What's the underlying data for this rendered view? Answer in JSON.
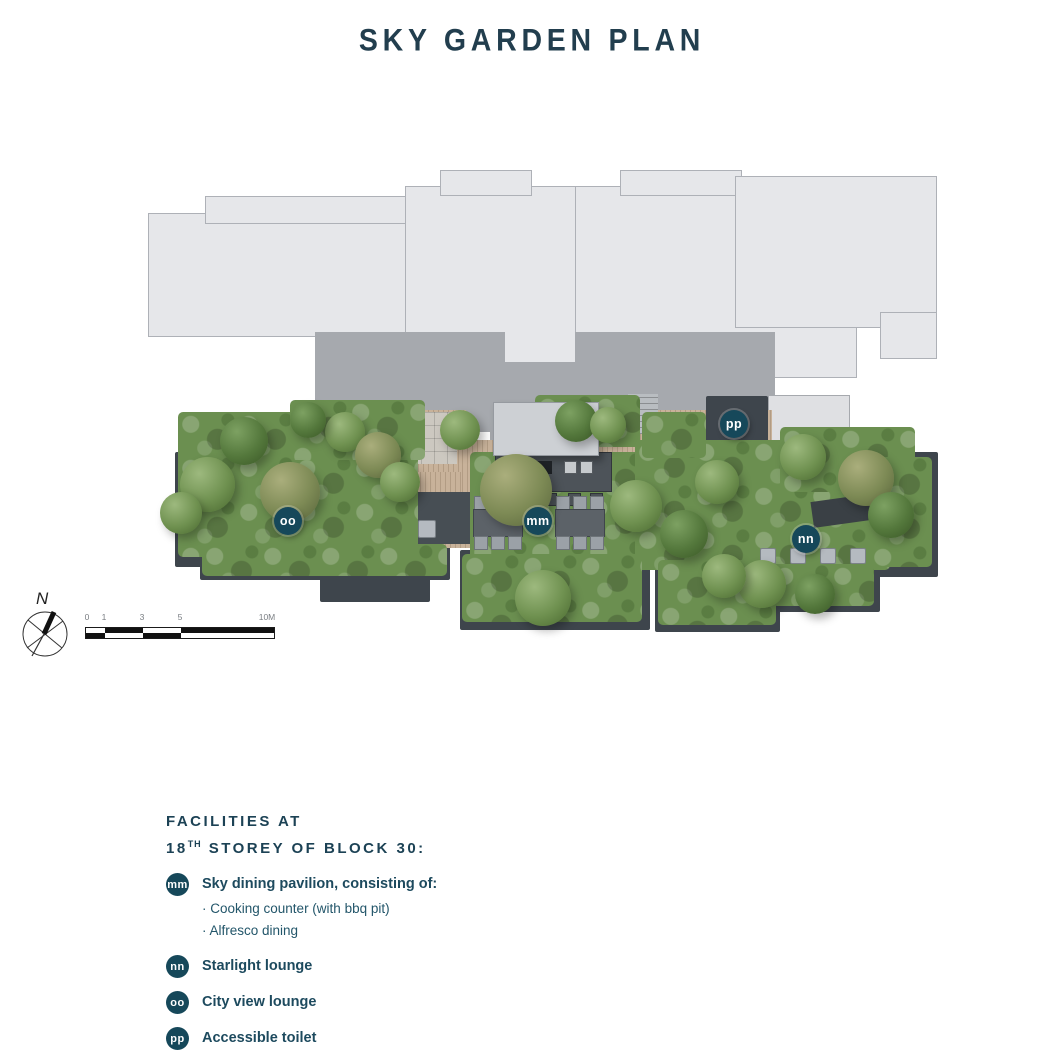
{
  "page": {
    "title": "SKY GARDEN PLAN"
  },
  "colors": {
    "accent_teal": "#16485a",
    "title_text": "#223e4e",
    "building_light": "#e6e7ea",
    "building_mid": "#a6a9ae",
    "planter_dark": "#3e454c",
    "deck_tan": "#c8b29a",
    "foliage_green": "#6b8f50"
  },
  "compass": {
    "label": "N"
  },
  "scale_bar": {
    "tick_labels": [
      "0",
      "1",
      "3",
      "5",
      "10M"
    ]
  },
  "plan": {
    "markers": [
      {
        "id": "mm",
        "label": "mm"
      },
      {
        "id": "nn",
        "label": "nn"
      },
      {
        "id": "oo",
        "label": "oo"
      },
      {
        "id": "pp",
        "label": "pp"
      }
    ]
  },
  "legend": {
    "heading_line1": "FACILITIES AT",
    "heading_line2_num": "18",
    "heading_line2_sup": "TH",
    "heading_line2_rest": "STOREY OF BLOCK 30:",
    "items": [
      {
        "code": "mm",
        "label": "Sky dining pavilion, consisting of:",
        "sub_items": [
          "Cooking counter (with bbq pit)",
          "Alfresco dining"
        ]
      },
      {
        "code": "nn",
        "label": "Starlight lounge",
        "sub_items": []
      },
      {
        "code": "oo",
        "label": "City view lounge",
        "sub_items": []
      },
      {
        "code": "pp",
        "label": "Accessible toilet",
        "sub_items": []
      }
    ]
  }
}
